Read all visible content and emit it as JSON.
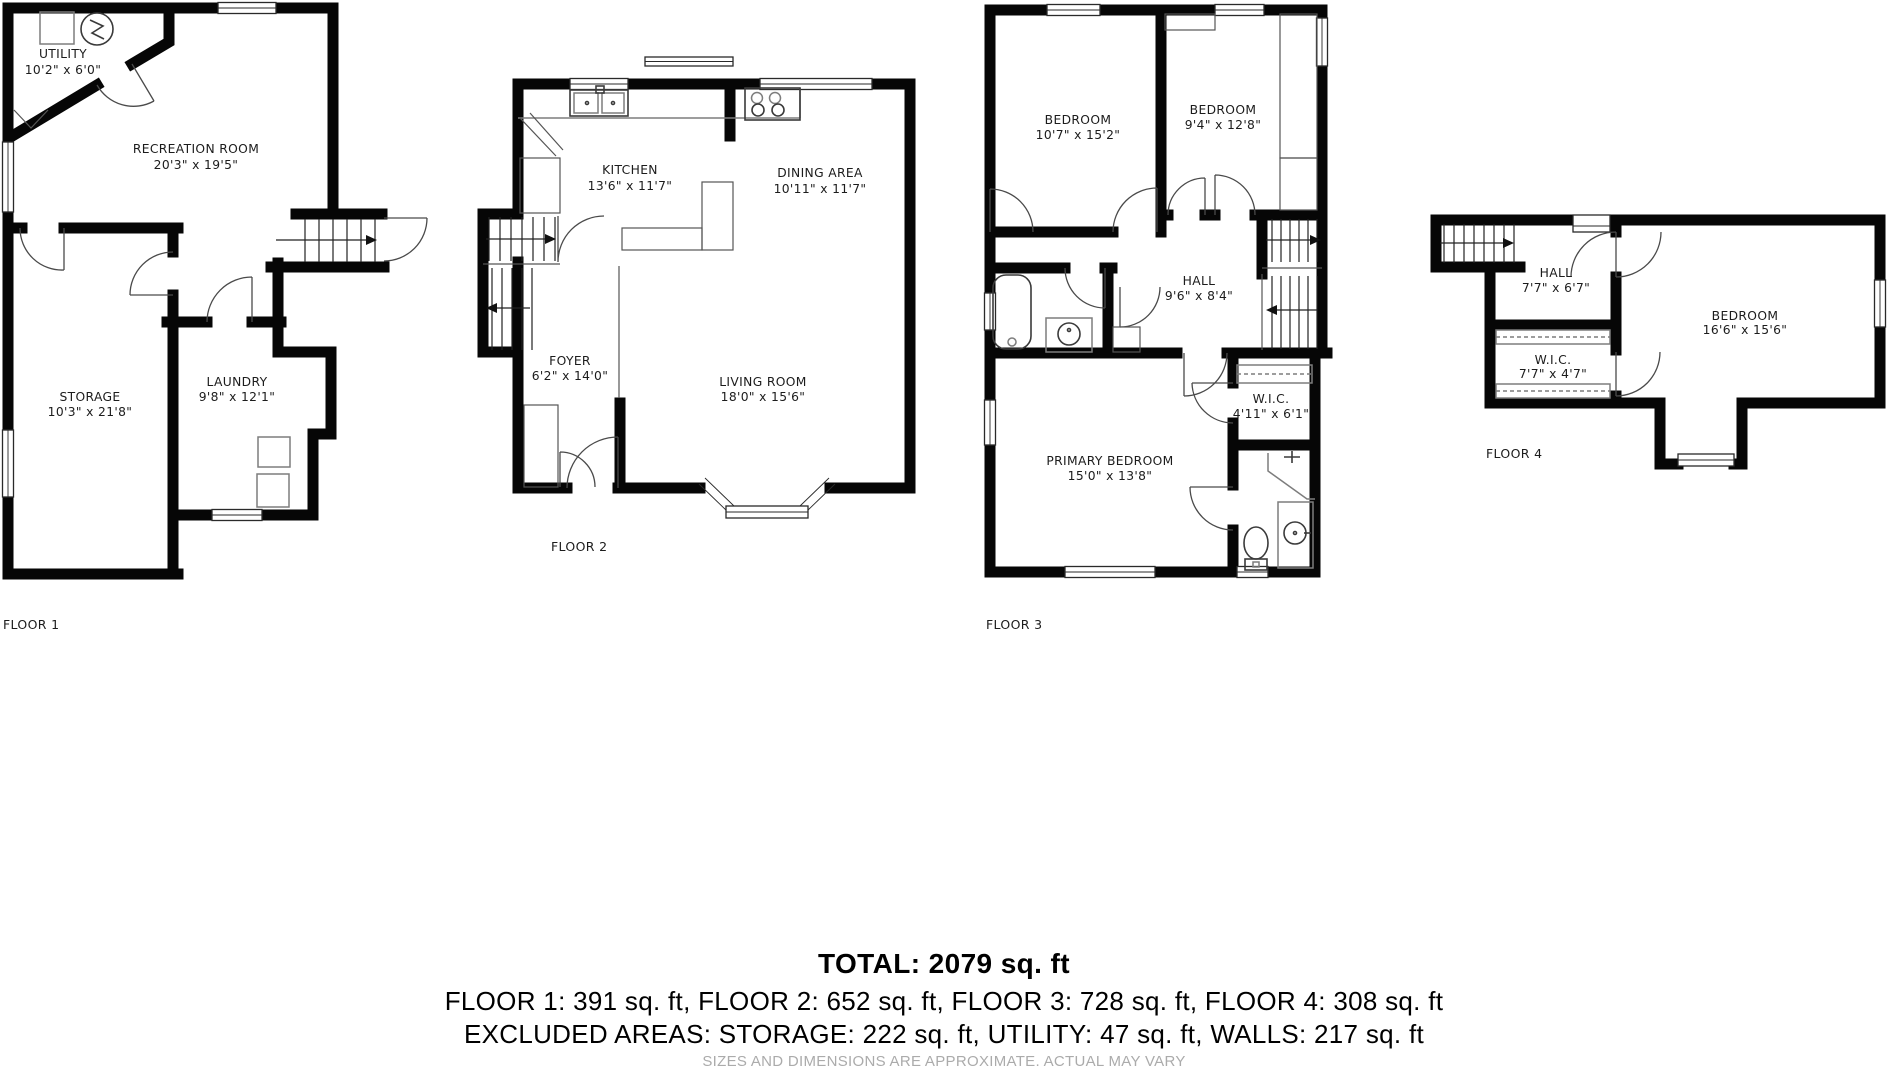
{
  "floors": [
    {
      "label": "FLOOR 1",
      "rooms": [
        {
          "name": "UTILITY",
          "dims": "10'2\" x 6'0\""
        },
        {
          "name": "RECREATION ROOM",
          "dims": "20'3\" x 19'5\""
        },
        {
          "name": "STORAGE",
          "dims": "10'3\" x 21'8\""
        },
        {
          "name": "LAUNDRY",
          "dims": "9'8\" x 12'1\""
        }
      ]
    },
    {
      "label": "FLOOR 2",
      "rooms": [
        {
          "name": "KITCHEN",
          "dims": "13'6\" x 11'7\""
        },
        {
          "name": "DINING AREA",
          "dims": "10'11\" x 11'7\""
        },
        {
          "name": "FOYER",
          "dims": "6'2\" x 14'0\""
        },
        {
          "name": "LIVING ROOM",
          "dims": "18'0\" x 15'6\""
        }
      ]
    },
    {
      "label": "FLOOR 3",
      "rooms": [
        {
          "name": "BEDROOM",
          "dims": "10'7\" x 15'2\""
        },
        {
          "name": "BEDROOM",
          "dims": "9'4\" x 12'8\""
        },
        {
          "name": "HALL",
          "dims": "9'6\" x 8'4\""
        },
        {
          "name": "W.I.C.",
          "dims": "4'11\" x 6'1\""
        },
        {
          "name": "PRIMARY BEDROOM",
          "dims": "15'0\" x 13'8\""
        }
      ]
    },
    {
      "label": "FLOOR 4",
      "rooms": [
        {
          "name": "HALL",
          "dims": "7'7\" x 6'7\""
        },
        {
          "name": "W.I.C.",
          "dims": "7'7\" x 4'7\""
        },
        {
          "name": "BEDROOM",
          "dims": "16'6\" x 15'6\""
        }
      ]
    }
  ],
  "summary": {
    "total": "TOTAL: 2079 sq. ft",
    "floors_line": "FLOOR 1: 391 sq. ft, FLOOR 2: 652 sq. ft, FLOOR 3: 728 sq. ft, FLOOR 4: 308 sq. ft",
    "excluded_line": "EXCLUDED AREAS: STORAGE: 222 sq. ft, UTILITY: 47 sq. ft, WALLS: 217 sq. ft",
    "disclaimer": "SIZES AND DIMENSIONS ARE APPROXIMATE, ACTUAL MAY VARY"
  },
  "colors": {
    "wall": "#060606",
    "text": "#1c1c1c",
    "fixture": "#7d7d7d",
    "disclaimer": "#ababab"
  }
}
